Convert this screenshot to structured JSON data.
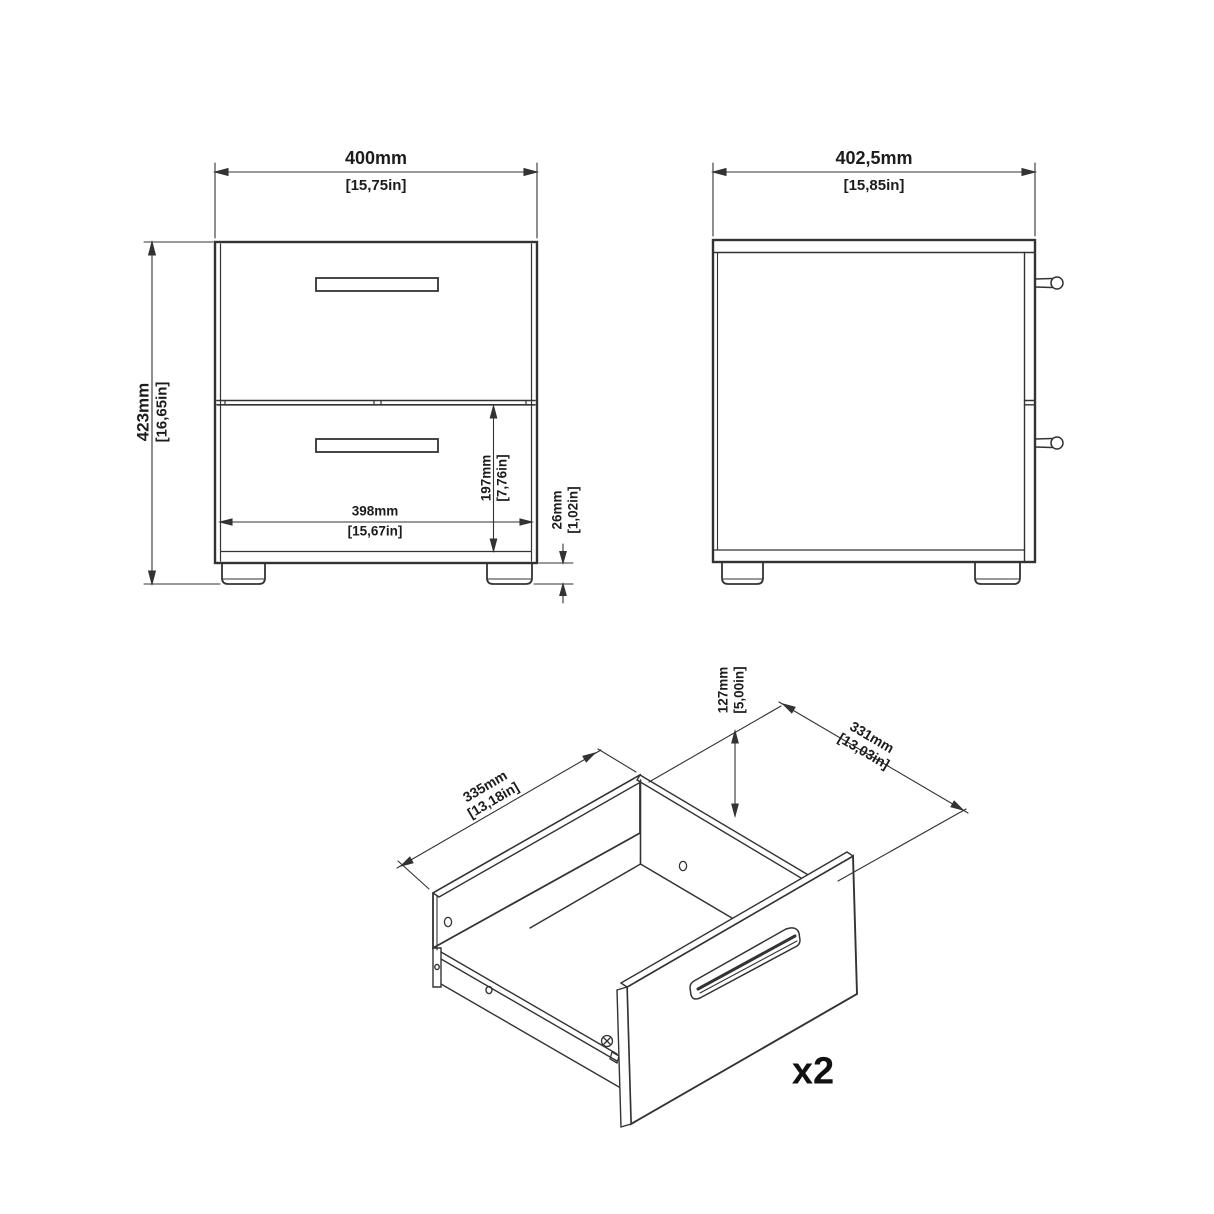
{
  "page": {
    "background": "#ffffff",
    "line_color": "#333333",
    "text_color": "#1c1c1c",
    "description": "Furniture dimension drawing: 2-drawer nightstand, front view, side view and isometric drawer detail"
  },
  "front_view": {
    "width_mm": "400mm",
    "width_in": "[15,75in]",
    "height_mm": "423mm",
    "height_in": "[16,65in]",
    "inner_width_mm": "398mm",
    "inner_width_in": "[15,67in]",
    "drawer_height_mm": "197mm",
    "drawer_height_in": "[7,76in]",
    "foot_height_mm": "26mm",
    "foot_height_in": "[1,02in]"
  },
  "side_view": {
    "depth_mm": "402,5mm",
    "depth_in": "[15,85in]"
  },
  "drawer_view": {
    "height_mm": "127mm",
    "height_in": "[5,00in]",
    "depth_mm": "335mm",
    "depth_in": "[13,18in]",
    "width_mm": "331mm",
    "width_in": "[13,03in]",
    "quantity": "x2"
  }
}
